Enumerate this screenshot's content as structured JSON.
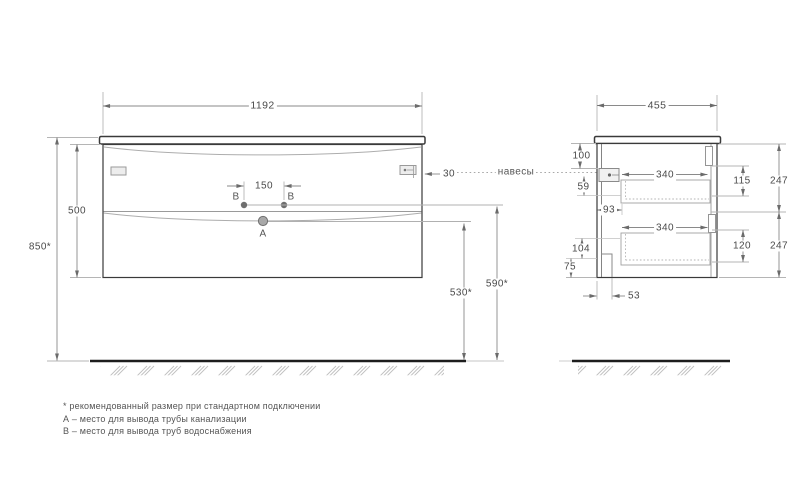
{
  "drawing": {
    "front": {
      "width": "1192",
      "height": "500",
      "install_height": "850*",
      "tap_spacing": "150",
      "hanger_offset": "30",
      "drain_outlet_height": "530*",
      "water_outlet_height": "590*",
      "point_a": "А",
      "point_b": "В"
    },
    "side": {
      "depth": "455",
      "top_to_hanger": "100",
      "hanger_zone": "59",
      "back_clearance": "93",
      "drawer_inner_depth": "340",
      "bottom_zone": "104",
      "plinth": "75",
      "notch_depth": "53",
      "drawer_inner_height_top": "115",
      "drawer_inner_height_bottom": "120",
      "front_panel_top": "247",
      "front_panel_bottom": "247"
    },
    "callouts": {
      "hangers": "навесы"
    },
    "footnotes": {
      "recommended": "* рекомендованный размер при стандартном подключении",
      "point_a": "А – место для вывода трубы канализации",
      "point_b": "В – место для вывода труб водоснабжения"
    },
    "colors": {
      "outline": "#3a3a3a",
      "dimension": "#8a8a8a",
      "floor": "#1d1d1d"
    }
  }
}
